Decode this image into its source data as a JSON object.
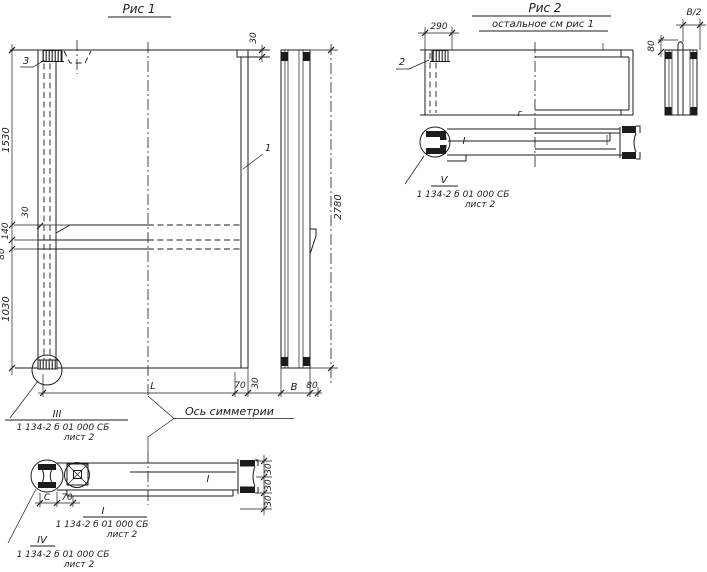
{
  "colors": {
    "ink": "#1c1c1c",
    "paper": "#ffffff"
  },
  "fig1": {
    "title": "Рис 1",
    "callout_3": "3",
    "callout_1": "1",
    "dim_1530": "1530",
    "dim_140": "140",
    "dim_80_left": "80",
    "dim_1030": "1030",
    "dim_30_chamfer": "30",
    "dim_30_topright": "30",
    "dim_2780": "2780",
    "dim_L": "L",
    "dim_70_bottom": "70",
    "dim_30_bottom": "30",
    "dim_B": "B",
    "dim_80_bottom": "80",
    "axis_label": "Ось симметрии",
    "dim_C": "C",
    "dim_70_section": "70",
    "dim_30_sec_1": "30",
    "dim_30_sec_2": "30",
    "dim_30_sec_3": "30",
    "section_mark": "I",
    "detail_III": {
      "numeral": "III",
      "doc": "1 134-2 б 01 000 СБ",
      "sheet": "лист 2"
    },
    "detail_I": {
      "numeral": "I",
      "doc": "1 134-2 б 01 000 СБ",
      "sheet": "лист 2"
    },
    "detail_IV": {
      "numeral": "IV",
      "doc": "1 134-2 б 01 000 СБ",
      "sheet": "лист 2"
    }
  },
  "fig2": {
    "title": "Рис 2",
    "subtitle": "остальное см рис 1",
    "callout_2": "2",
    "dim_290": "290",
    "dim_80": "80",
    "dim_B2": "В/2",
    "section_letter": "г",
    "section_mark": "I",
    "detail_V": {
      "numeral": "V",
      "doc": "1 134-2 б 01 000 СБ",
      "sheet": "лист 2"
    }
  }
}
